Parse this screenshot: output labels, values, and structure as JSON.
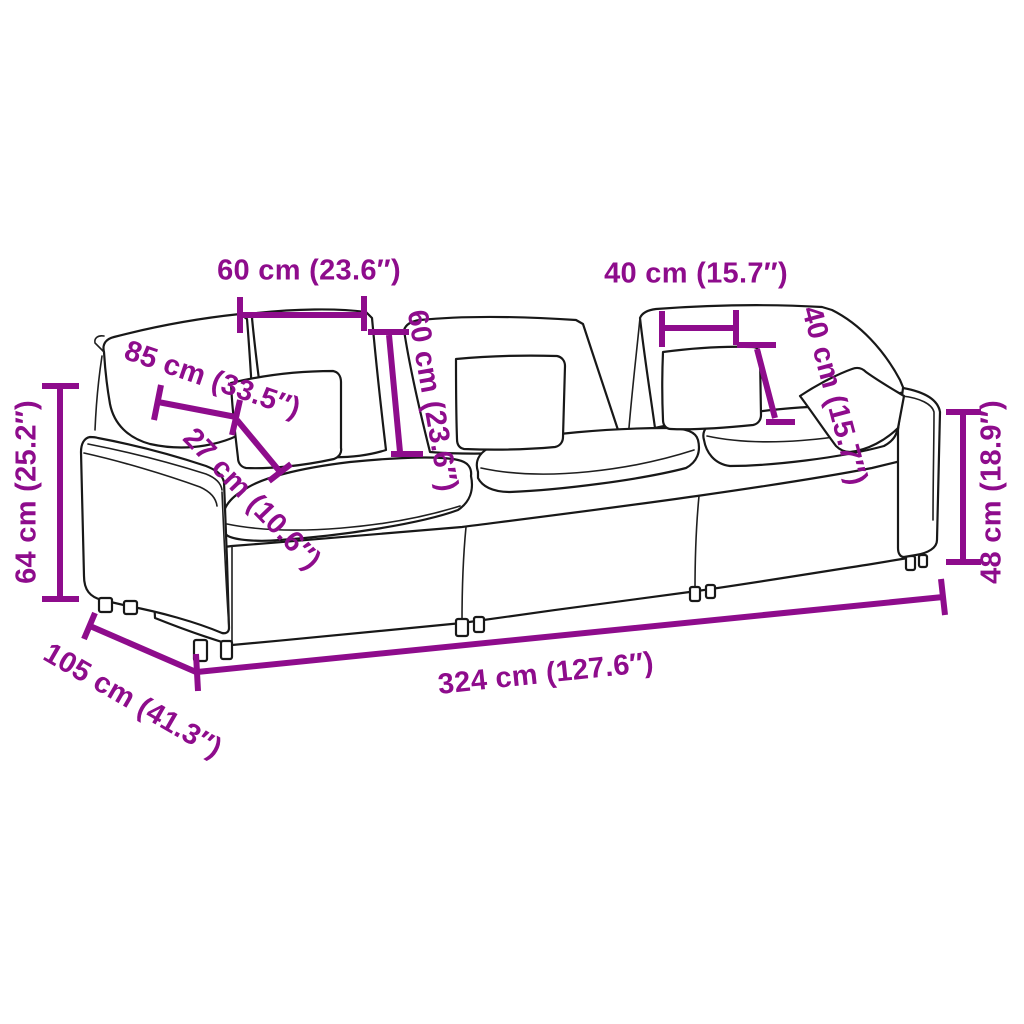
{
  "diagram": {
    "subject": "3-seat modular sofa dimension drawing",
    "background": "#ffffff",
    "accent_color": "#8E0C8C",
    "outline_color": "#181818"
  },
  "dimensions": [
    {
      "id": "back-cushion-width",
      "label": "60 cm (23.6″)",
      "value_cm": 60,
      "value_in": 23.6,
      "orientation": "horizontal"
    },
    {
      "id": "throw-pillow-width",
      "label": "40 cm (15.7″)",
      "value_cm": 40,
      "value_in": 15.7,
      "orientation": "horizontal"
    },
    {
      "id": "back-cushion-height",
      "label": "60 cm (23.6″)",
      "value_cm": 60,
      "value_in": 23.6,
      "orientation": "vertical-rotated"
    },
    {
      "id": "throw-pillow-height",
      "label": "40 cm (15.7″)",
      "value_cm": 40,
      "value_in": 15.7,
      "orientation": "vertical-rotated"
    },
    {
      "id": "seat-depth",
      "label": "85 cm (33.5″)",
      "value_cm": 85,
      "value_in": 33.5,
      "orientation": "diagonal"
    },
    {
      "id": "seat-cushion-thickness",
      "label": "27 cm (10.6″)",
      "value_cm": 27,
      "value_in": 10.6,
      "orientation": "diagonal"
    },
    {
      "id": "overall-height",
      "label": "64 cm (25.2″)",
      "value_cm": 64,
      "value_in": 25.2,
      "orientation": "vertical"
    },
    {
      "id": "arm-height",
      "label": "48 cm (18.9″)",
      "value_cm": 48,
      "value_in": 18.9,
      "orientation": "vertical"
    },
    {
      "id": "overall-depth",
      "label": "105 cm (41.3″)",
      "value_cm": 105,
      "value_in": 41.3,
      "orientation": "diagonal"
    },
    {
      "id": "overall-width",
      "label": "324 cm (127.6″)",
      "value_cm": 324,
      "value_in": 127.6,
      "orientation": "horizontal-slanted"
    }
  ]
}
